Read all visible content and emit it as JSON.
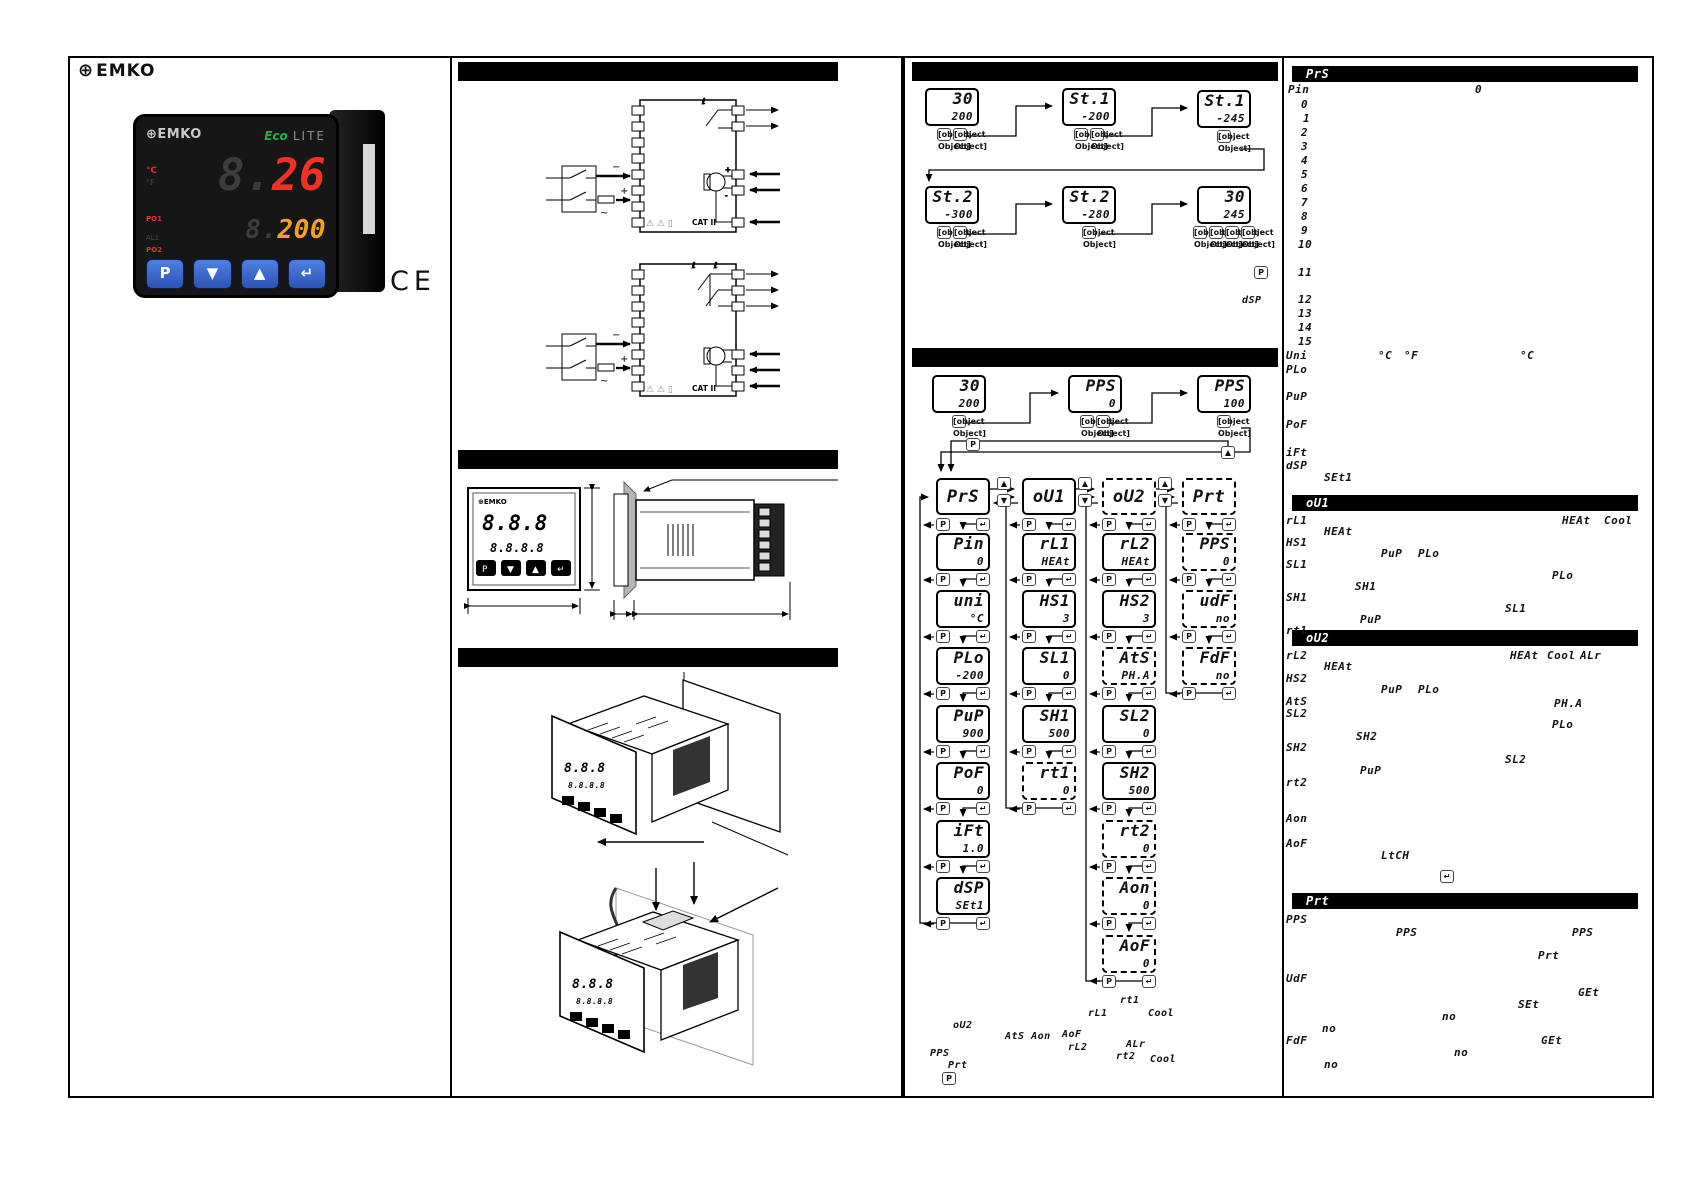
{
  "brand": {
    "gear": "⊕",
    "name": "EMKO"
  },
  "ce_mark": "CE",
  "keys": {
    "p": "P",
    "down": "▼",
    "up": "▲",
    "enter": "↵"
  },
  "product": {
    "gear": "⊕",
    "name": "EMKO",
    "eco": "Eco",
    "lite": "LITE",
    "c": "°C",
    "f": "°F",
    "po1": "PO1",
    "al1": "AL1",
    "po2": "PO2",
    "pv_ghost": "8.",
    "pv": "26",
    "sv_ghost": "8.",
    "sv": "200",
    "key_p": "P",
    "key_down": "▼",
    "key_up": "▲",
    "key_enter": "↵"
  },
  "wiring": {
    "cat": "CAT II",
    "warn": "⚠ ⚠ ▯",
    "plus": "+",
    "minus": "−",
    "ac": "~"
  },
  "dim_front": {
    "logo": "⊕EMKO",
    "pv": "8.8.8",
    "sv": "8.8.8.8",
    "k1": "P",
    "k2": "▼",
    "k3": "▲",
    "k4": "↵"
  },
  "standalone": {
    "dsp": "dSP"
  },
  "flow_displays": [
    {
      "x": 925,
      "y": 88,
      "top": "30",
      "bottom": "200",
      "cls": "",
      "keys": [
        "▼",
        "▲"
      ]
    },
    {
      "x": 1062,
      "y": 88,
      "top": "St.1",
      "bottom": "-200",
      "cls": "",
      "keys": [
        "▼",
        "▲"
      ]
    },
    {
      "x": 1197,
      "y": 90,
      "top": "St.1",
      "bottom": "-245",
      "cls": "",
      "keys": [
        "↵"
      ]
    },
    {
      "x": 925,
      "y": 186,
      "top": "St.2",
      "bottom": "-300",
      "cls": "",
      "keys": [
        "▼",
        "▲"
      ]
    },
    {
      "x": 1062,
      "y": 186,
      "top": "St.2",
      "bottom": "-280",
      "cls": "",
      "keys": [
        "↵"
      ]
    },
    {
      "x": 1197,
      "y": 186,
      "top": "30",
      "bottom": "245",
      "cls": "",
      "keys": [
        "P",
        "▼",
        "▲",
        "↵"
      ]
    },
    {
      "x": 932,
      "y": 375,
      "top": "30",
      "bottom": "200",
      "cls": "",
      "keys": [
        "P"
      ]
    },
    {
      "x": 1068,
      "y": 375,
      "top": "PPS",
      "bottom": "0",
      "cls": "",
      "keys": [
        "▼",
        "▲"
      ]
    },
    {
      "x": 1197,
      "y": 375,
      "top": "PPS",
      "bottom": "100",
      "cls": "",
      "keys": [
        "↵"
      ]
    }
  ],
  "tree": {
    "roots": [
      {
        "label": "PrS",
        "x": 936,
        "y": 478,
        "cls": ""
      },
      {
        "label": "oU1",
        "x": 1022,
        "y": 478,
        "cls": ""
      },
      {
        "label": "oU2",
        "x": 1102,
        "y": 478,
        "cls": "dashed"
      },
      {
        "label": "Prt",
        "x": 1182,
        "y": 478,
        "cls": "dashed"
      }
    ],
    "items": [
      {
        "label": "Pin",
        "value": "0",
        "x": 936,
        "y": 533,
        "cls": ""
      },
      {
        "label": "uni",
        "value": "°C",
        "x": 936,
        "y": 590,
        "cls": ""
      },
      {
        "label": "PLo",
        "value": "-200",
        "x": 936,
        "y": 647,
        "cls": ""
      },
      {
        "label": "PuP",
        "value": "900",
        "x": 936,
        "y": 705,
        "cls": ""
      },
      {
        "label": "PoF",
        "value": "0",
        "x": 936,
        "y": 762,
        "cls": ""
      },
      {
        "label": "iFt",
        "value": "1.0",
        "x": 936,
        "y": 820,
        "cls": ""
      },
      {
        "label": "dSP",
        "value": "SEt1",
        "x": 936,
        "y": 877,
        "cls": ""
      },
      {
        "label": "rL1",
        "value": "HEAt",
        "x": 1022,
        "y": 533,
        "cls": ""
      },
      {
        "label": "HS1",
        "value": "3",
        "x": 1022,
        "y": 590,
        "cls": ""
      },
      {
        "label": "SL1",
        "value": "0",
        "x": 1022,
        "y": 647,
        "cls": ""
      },
      {
        "label": "SH1",
        "value": "500",
        "x": 1022,
        "y": 705,
        "cls": ""
      },
      {
        "label": "rt1",
        "value": "0",
        "x": 1022,
        "y": 762,
        "cls": "dashed"
      },
      {
        "label": "rL2",
        "value": "HEAt",
        "x": 1102,
        "y": 533,
        "cls": ""
      },
      {
        "label": "HS2",
        "value": "3",
        "x": 1102,
        "y": 590,
        "cls": ""
      },
      {
        "label": "AtS",
        "value": "PH.A",
        "x": 1102,
        "y": 647,
        "cls": "dashed"
      },
      {
        "label": "SL2",
        "value": "0",
        "x": 1102,
        "y": 705,
        "cls": ""
      },
      {
        "label": "SH2",
        "value": "500",
        "x": 1102,
        "y": 762,
        "cls": ""
      },
      {
        "label": "rt2",
        "value": "0",
        "x": 1102,
        "y": 820,
        "cls": "dashed"
      },
      {
        "label": "Aon",
        "value": "0",
        "x": 1102,
        "y": 877,
        "cls": "dashed"
      },
      {
        "label": "AoF",
        "value": "0",
        "x": 1102,
        "y": 935,
        "cls": "dashed"
      },
      {
        "label": "PPS",
        "value": "0",
        "x": 1182,
        "y": 533,
        "cls": "dashed"
      },
      {
        "label": "udF",
        "value": "no",
        "x": 1182,
        "y": 590,
        "cls": "dashed"
      },
      {
        "label": "FdF",
        "value": "no",
        "x": 1182,
        "y": 647,
        "cls": "dashed"
      }
    ]
  },
  "annotations": [
    {
      "t": "rt1",
      "x": 1120,
      "y": 996
    },
    {
      "t": "rL1",
      "x": 1088,
      "y": 1009
    },
    {
      "t": "Cool",
      "x": 1148,
      "y": 1009
    },
    {
      "t": "oU2",
      "x": 953,
      "y": 1021
    },
    {
      "t": "AtS Aon",
      "x": 1005,
      "y": 1032
    },
    {
      "t": "AoF",
      "x": 1062,
      "y": 1030
    },
    {
      "t": "rL2",
      "x": 1068,
      "y": 1043
    },
    {
      "t": "ALr",
      "x": 1126,
      "y": 1040
    },
    {
      "t": "rt2",
      "x": 1116,
      "y": 1052
    },
    {
      "t": "Cool",
      "x": 1150,
      "y": 1055
    },
    {
      "t": "PPS",
      "x": 930,
      "y": 1049
    },
    {
      "t": "Prt",
      "x": 948,
      "y": 1061
    }
  ],
  "col4": {
    "sections": {
      "prs": "PrS",
      "ou1": "oU1",
      "ou2": "oU2",
      "prt": "Prt"
    },
    "labels": [
      {
        "t": "Pin",
        "x": 1288,
        "y": 84
      },
      {
        "t": "0",
        "x": 1475,
        "y": 84
      },
      {
        "t": "0",
        "x": 1301,
        "y": 99
      },
      {
        "t": "1",
        "x": 1303,
        "y": 113
      },
      {
        "t": "2",
        "x": 1301,
        "y": 127
      },
      {
        "t": "3",
        "x": 1301,
        "y": 141
      },
      {
        "t": "4",
        "x": 1301,
        "y": 155
      },
      {
        "t": "5",
        "x": 1301,
        "y": 169
      },
      {
        "t": "6",
        "x": 1301,
        "y": 183
      },
      {
        "t": "7",
        "x": 1301,
        "y": 197
      },
      {
        "t": "8",
        "x": 1301,
        "y": 211
      },
      {
        "t": "9",
        "x": 1301,
        "y": 225
      },
      {
        "t": "10",
        "x": 1298,
        "y": 239
      },
      {
        "t": "11",
        "x": 1298,
        "y": 267
      },
      {
        "t": "12",
        "x": 1298,
        "y": 294
      },
      {
        "t": "13",
        "x": 1298,
        "y": 308
      },
      {
        "t": "14",
        "x": 1298,
        "y": 322
      },
      {
        "t": "15",
        "x": 1298,
        "y": 336
      },
      {
        "t": "Uni",
        "x": 1286,
        "y": 350
      },
      {
        "t": "°C",
        "x": 1378,
        "y": 350
      },
      {
        "t": "°F",
        "x": 1404,
        "y": 350
      },
      {
        "t": "°C",
        "x": 1520,
        "y": 350
      },
      {
        "t": "PLo",
        "x": 1286,
        "y": 364
      },
      {
        "t": "PuP",
        "x": 1286,
        "y": 391
      },
      {
        "t": "PoF",
        "x": 1286,
        "y": 419
      },
      {
        "t": "iFt",
        "x": 1286,
        "y": 447
      },
      {
        "t": "dSP",
        "x": 1286,
        "y": 460
      },
      {
        "t": "SEt1",
        "x": 1324,
        "y": 472
      },
      {
        "t": "rL1",
        "x": 1286,
        "y": 515
      },
      {
        "t": "HEAt",
        "x": 1562,
        "y": 515
      },
      {
        "t": "Cool",
        "x": 1604,
        "y": 515
      },
      {
        "t": "HEAt",
        "x": 1324,
        "y": 526
      },
      {
        "t": "HS1",
        "x": 1286,
        "y": 537
      },
      {
        "t": "PuP",
        "x": 1381,
        "y": 548
      },
      {
        "t": "PLo",
        "x": 1418,
        "y": 548
      },
      {
        "t": "SL1",
        "x": 1286,
        "y": 559
      },
      {
        "t": "PLo",
        "x": 1552,
        "y": 570
      },
      {
        "t": "SH1",
        "x": 1355,
        "y": 581
      },
      {
        "t": "SH1",
        "x": 1286,
        "y": 592
      },
      {
        "t": "SL1",
        "x": 1505,
        "y": 603
      },
      {
        "t": "PuP",
        "x": 1360,
        "y": 614
      },
      {
        "t": "rt1",
        "x": 1286,
        "y": 625
      },
      {
        "t": "rL2",
        "x": 1286,
        "y": 650
      },
      {
        "t": "HEAt",
        "x": 1510,
        "y": 650
      },
      {
        "t": "Cool",
        "x": 1547,
        "y": 650
      },
      {
        "t": "ALr",
        "x": 1580,
        "y": 650
      },
      {
        "t": "HEAt",
        "x": 1324,
        "y": 661
      },
      {
        "t": "HS2",
        "x": 1286,
        "y": 673
      },
      {
        "t": "PuP",
        "x": 1381,
        "y": 684
      },
      {
        "t": "PLo",
        "x": 1418,
        "y": 684
      },
      {
        "t": "AtS",
        "x": 1286,
        "y": 696
      },
      {
        "t": "PH.A",
        "x": 1554,
        "y": 698
      },
      {
        "t": "SL2",
        "x": 1286,
        "y": 708
      },
      {
        "t": "PLo",
        "x": 1552,
        "y": 719
      },
      {
        "t": "SH2",
        "x": 1356,
        "y": 731
      },
      {
        "t": "SH2",
        "x": 1286,
        "y": 742
      },
      {
        "t": "SL2",
        "x": 1505,
        "y": 754
      },
      {
        "t": "PuP",
        "x": 1360,
        "y": 765
      },
      {
        "t": "rt2",
        "x": 1286,
        "y": 777
      },
      {
        "t": "Aon",
        "x": 1286,
        "y": 813
      },
      {
        "t": "AoF",
        "x": 1286,
        "y": 838
      },
      {
        "t": "LtCH",
        "x": 1381,
        "y": 850
      },
      {
        "t": "PPS",
        "x": 1286,
        "y": 914
      },
      {
        "t": "PPS",
        "x": 1396,
        "y": 927
      },
      {
        "t": "PPS",
        "x": 1572,
        "y": 927
      },
      {
        "t": "Prt",
        "x": 1538,
        "y": 950
      },
      {
        "t": "UdF",
        "x": 1286,
        "y": 973
      },
      {
        "t": "GEt",
        "x": 1578,
        "y": 987
      },
      {
        "t": "SEt",
        "x": 1518,
        "y": 999
      },
      {
        "t": "no",
        "x": 1442,
        "y": 1011
      },
      {
        "t": "no",
        "x": 1322,
        "y": 1023
      },
      {
        "t": "FdF",
        "x": 1286,
        "y": 1035
      },
      {
        "t": "GEt",
        "x": 1541,
        "y": 1035
      },
      {
        "t": "no",
        "x": 1454,
        "y": 1047
      },
      {
        "t": "no",
        "x": 1324,
        "y": 1059
      }
    ]
  }
}
